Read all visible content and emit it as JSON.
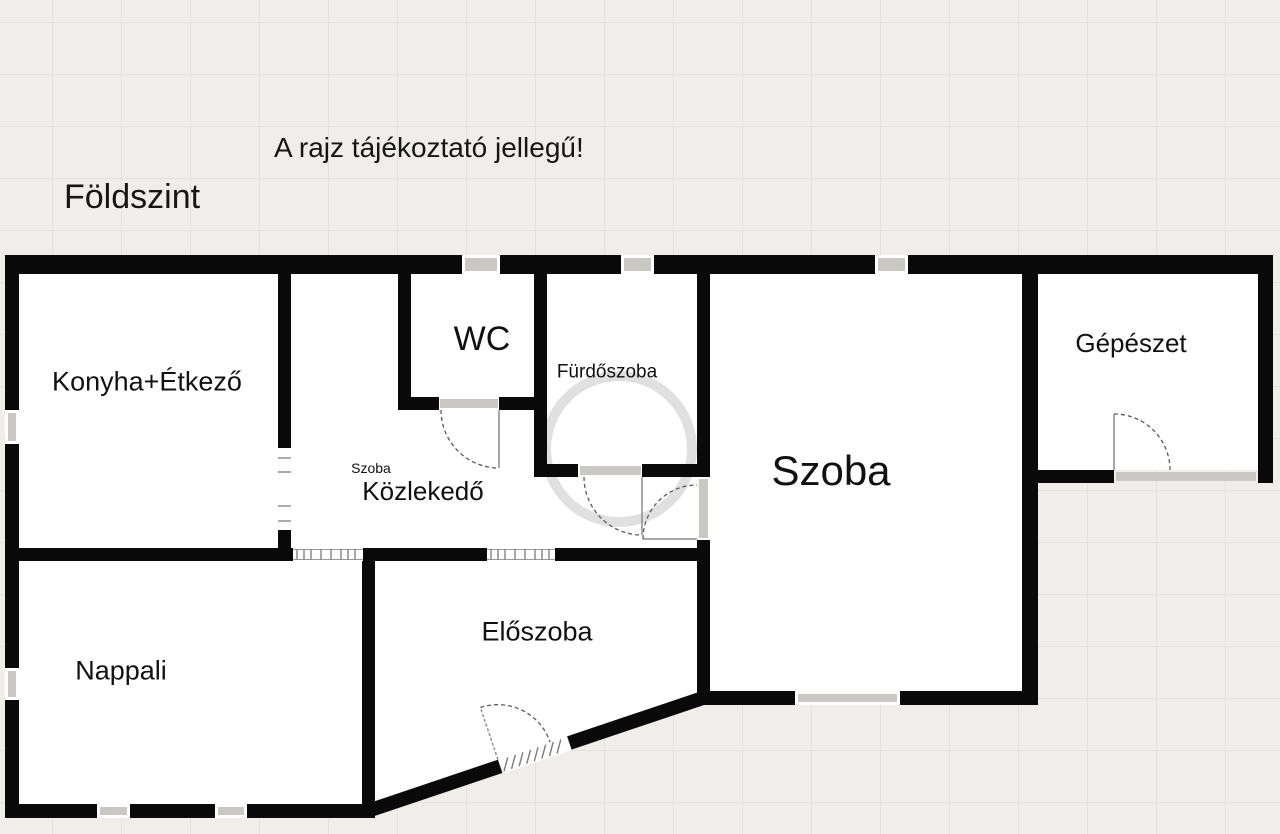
{
  "header": {
    "disclaimer": "A rajz tájékoztató jellegű!",
    "floor_title": "Földszint"
  },
  "rooms": {
    "konyha": "Konyha+Étkező",
    "wc": "WC",
    "furdoszoba": "Fürdőszoba",
    "szoba_kis": "Szoba",
    "kozlekedo": "Közlekedő",
    "szoba": "Szoba",
    "gepeszet": "Gépészet",
    "nappali": "Nappali",
    "eloszoba": "Előszoba"
  },
  "colors": {
    "wall": "#0a0a0a",
    "room_fill": "#ffffff",
    "background": "#efeeea",
    "grid_line": "#e4e2dd",
    "window": "#c9c8c5",
    "door_arc": "#5a5a5a",
    "text": "#161616"
  }
}
